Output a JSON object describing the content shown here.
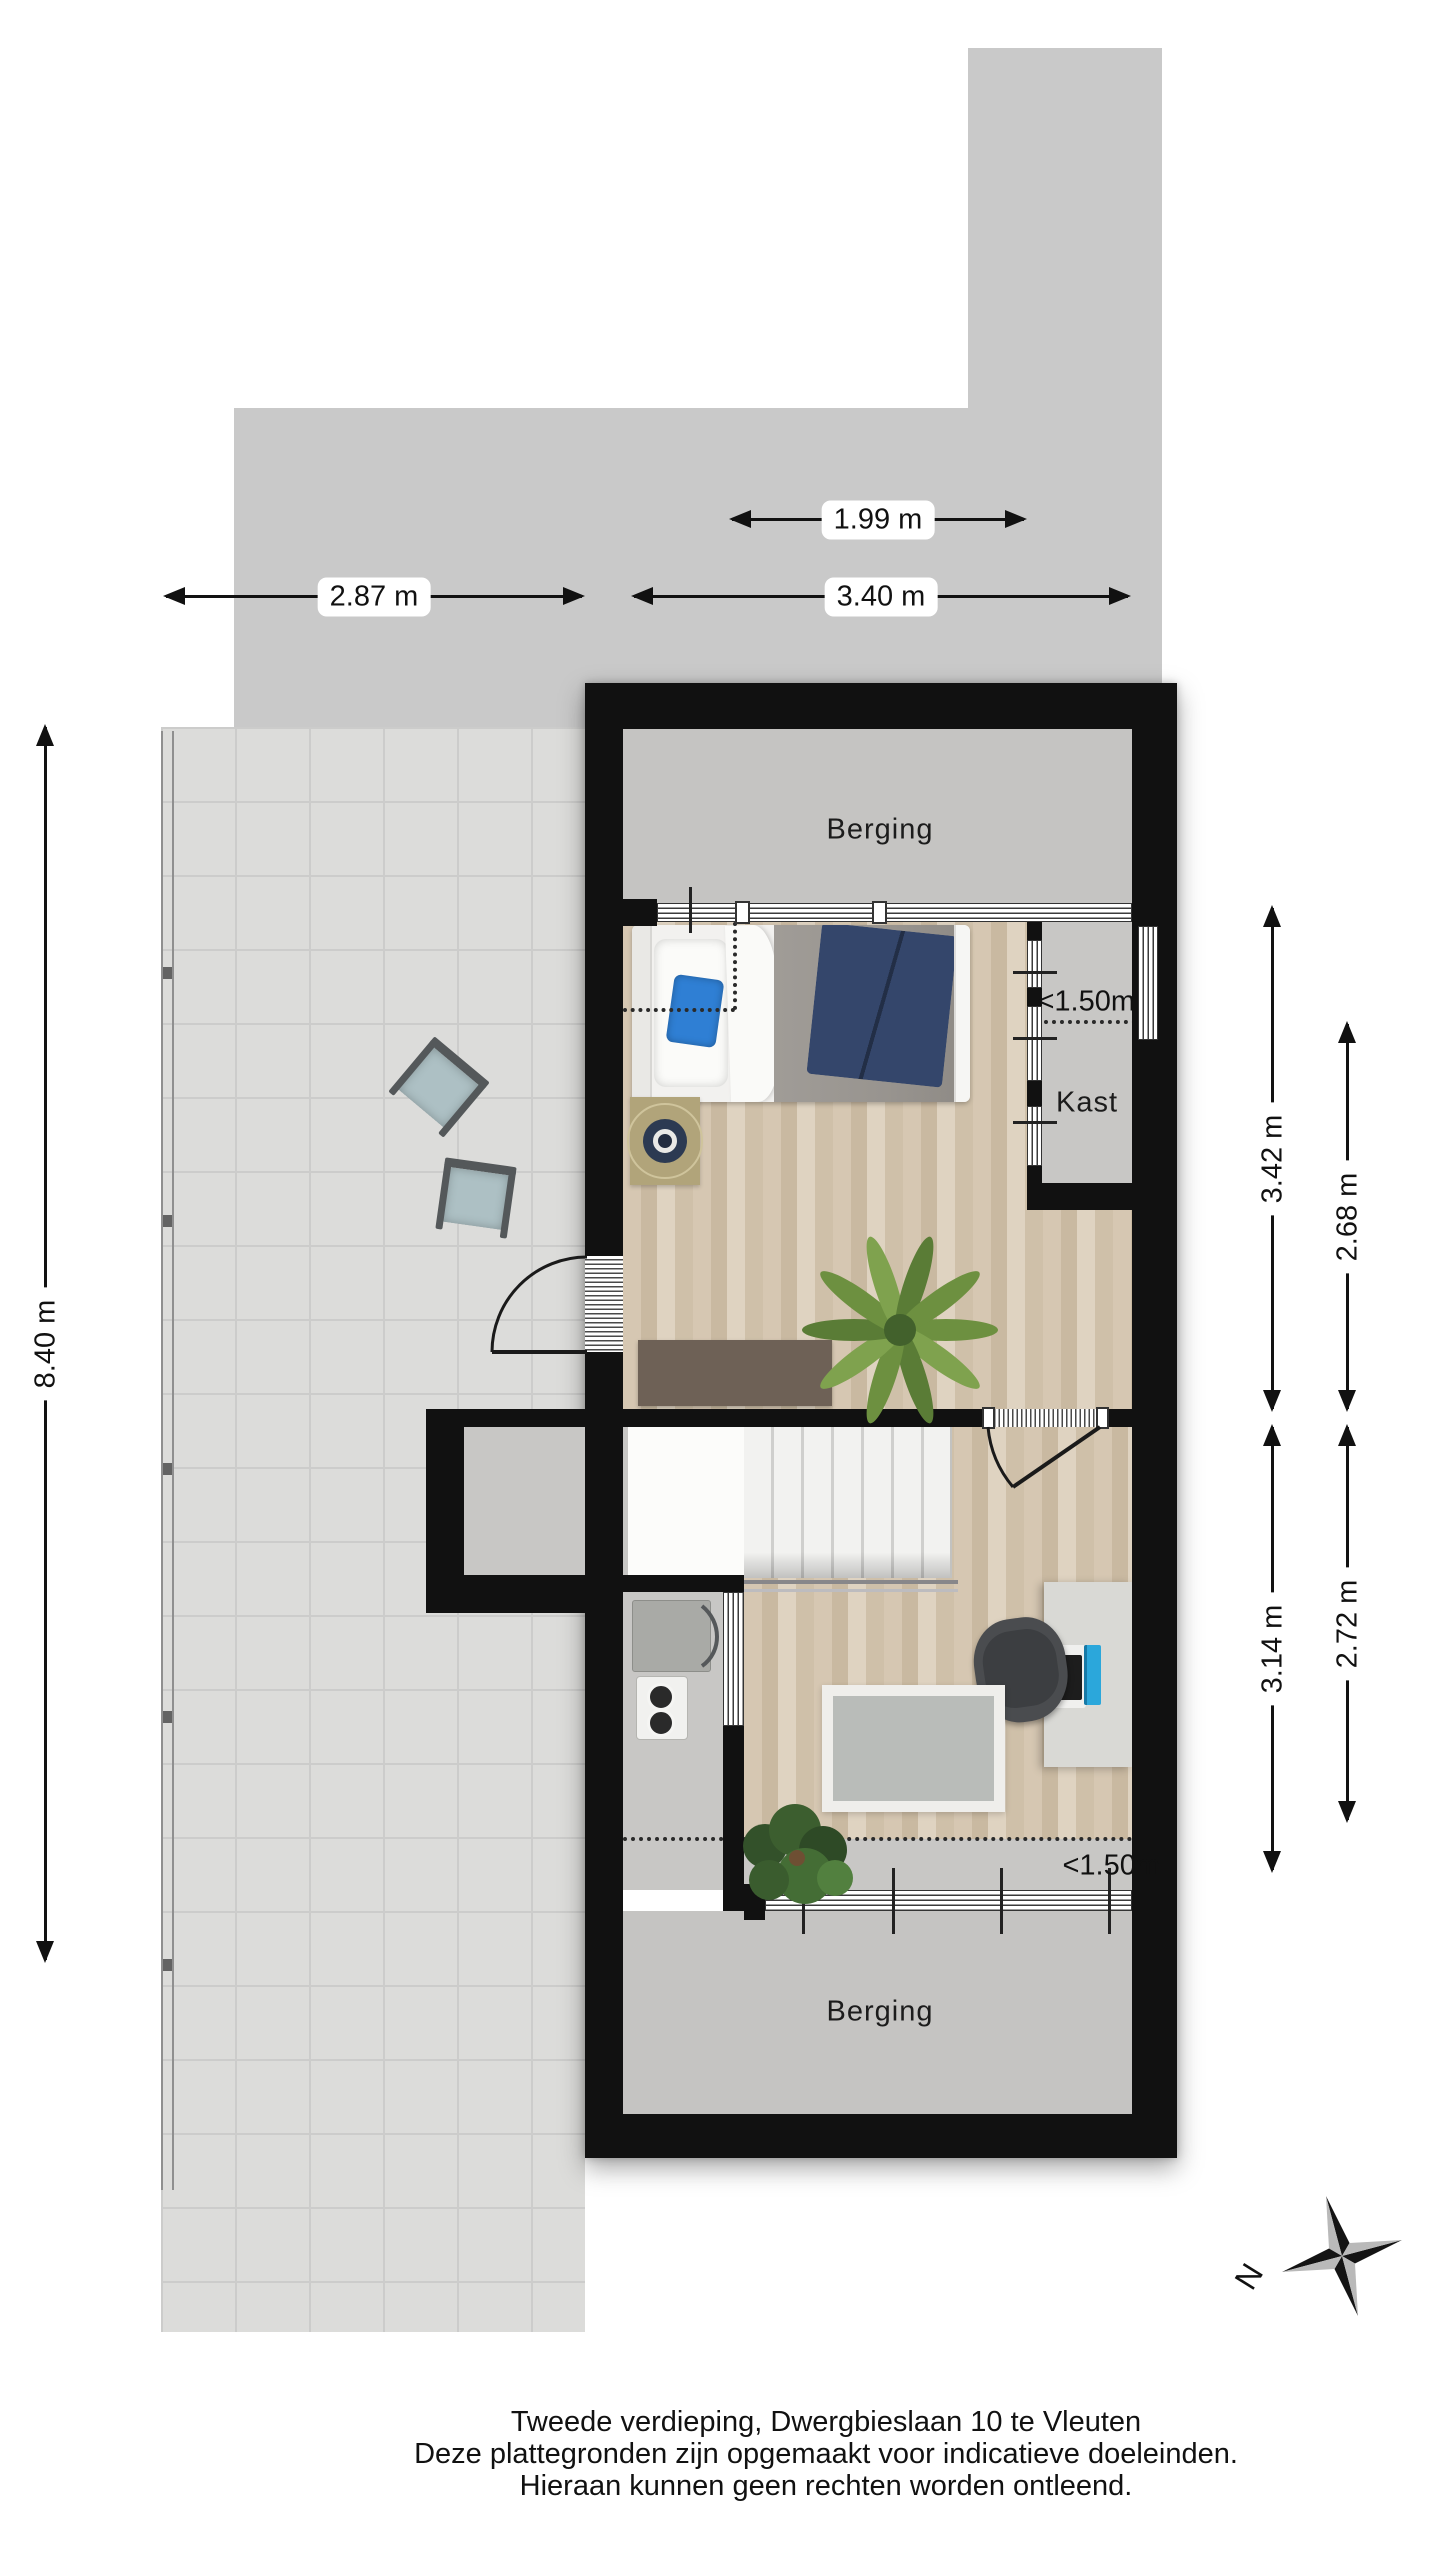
{
  "plan": {
    "floor_name": "Tweede verdieping",
    "address": "Dwergbieslaan 10 te Vleuten"
  },
  "rooms": {
    "berging_top": "Berging",
    "kast": "Kast",
    "berging_bottom": "Berging"
  },
  "headroom": {
    "top": "<1.50m",
    "bottom": "<1.50m"
  },
  "dimensions": {
    "top_inner_width": "1.99 m",
    "terrace_width": "2.87 m",
    "main_width": "3.40 m",
    "terrace_length": "8.40 m",
    "bedroom_depth_a": "3.42 m",
    "bedroom_depth_b": "2.68 m",
    "study_depth_a": "3.14 m",
    "study_depth_b": "2.72 m"
  },
  "compass": {
    "north_label": "N"
  },
  "footer": {
    "line1": "Tweede verdieping, Dwergbieslaan 10 te Vleuten",
    "line2": "Deze plattegronden zijn opgemaakt voor indicatieve doeleinden.",
    "line3": "Hieraan kunnen geen rechten worden ontleend."
  },
  "colors": {
    "wall": "#111111",
    "roof_gray": "#c9c9c9",
    "terrace_tile": "#dcdcda",
    "interior_gray": "#c5c4c2",
    "wood_floor": "#d6c7b2",
    "accent_pillow_blue": "#2f7fd4",
    "blanket_navy": "#34466b",
    "monitor_cyan": "#2ba7db",
    "plant_green": "#6d9040"
  }
}
